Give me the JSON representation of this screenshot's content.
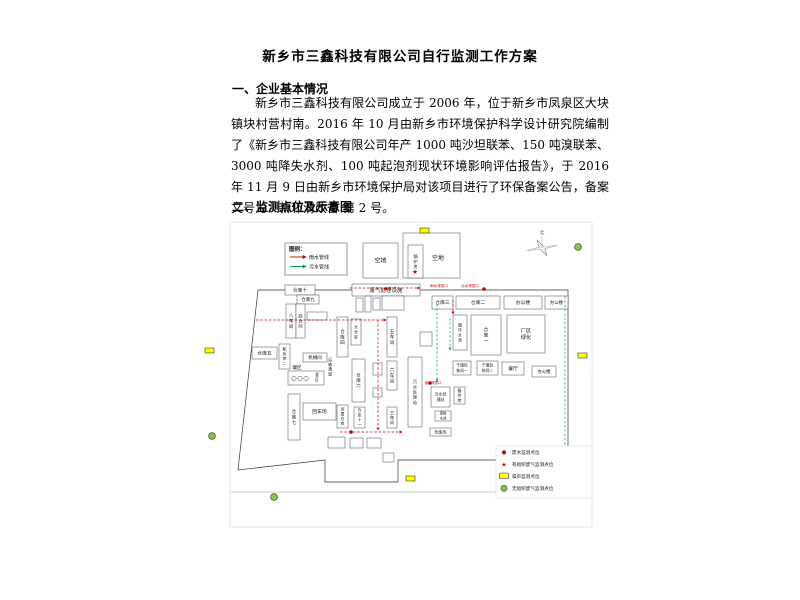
{
  "document": {
    "title": "新乡市三鑫科技有限公司自行监测工作方案",
    "section1_heading": "一、企业基本情况",
    "section1_paragraph": "新乡市三鑫科技有限公司成立于 2006 年，位于新乡市凤泉区大块镇块村营村南。2016 年 10 月由新乡市环境保护科学设计研究院编制了《新乡市三鑫科技有限公司年产 1000 吨沙坦联苯、150 吨溴联苯、3000 吨降失水剂、100 吨起泡剂现状环境影响评估报告》，于 2016 年 11 月 9 日由新乡市环境保护局对该项目进行了环保备案公告，备案文号为：新环清改备 第 2 号。",
    "section2_heading": "二、监测点位及示意图"
  },
  "diagram": {
    "compass_label": "北",
    "colors": {
      "rain": "#c00000",
      "sewage": "#00994d",
      "noise_fill": "#ffff00",
      "fugitive_fill": "#8bc34a",
      "fugitive_stroke": "#33691e",
      "marker_red": "#c00000"
    },
    "pipe_legend": {
      "title": "图例：",
      "items": [
        {
          "label": "雨水管线",
          "color": "#c00000"
        },
        {
          "label": "污水管线",
          "color": "#00994d"
        }
      ]
    },
    "point_legend": [
      {
        "icon": "wastewater-dot",
        "label": "废水监测点位"
      },
      {
        "icon": "stack-gas-star",
        "label": "有组织废气监测点位"
      },
      {
        "icon": "noise-rect",
        "label": "噪声监测点位"
      },
      {
        "icon": "fugitive-gas-circle",
        "label": "无组织废气监测点位"
      }
    ],
    "frame": {
      "x": 30,
      "y": 2,
      "w": 362,
      "h": 305
    },
    "road": {
      "x1": 31,
      "y1": 272,
      "x2": 390,
      "y2": 272
    },
    "fence_path": "M58,70 L368,70 L368,240 L198,240 L198,262 L125,262 L125,240 L38,250 Z",
    "boxes": [
      {
        "x": 85,
        "y": 65,
        "w": 30,
        "h": 10,
        "label": "仓库十",
        "m": "h",
        "fs": 4.8
      },
      {
        "x": 97,
        "y": 75,
        "w": 22,
        "h": 9,
        "label": "仓库九",
        "m": "h",
        "fs": 4.5
      },
      {
        "x": 86,
        "y": 84,
        "w": 10,
        "h": 34,
        "label": "八车间",
        "m": "v",
        "fs": 4.5
      },
      {
        "x": 96,
        "y": 84,
        "w": 9,
        "h": 34,
        "label": "综合间",
        "m": "v",
        "fs": 4.2
      },
      {
        "x": 107,
        "y": 92,
        "w": 20,
        "h": 8,
        "label": "",
        "m": "h"
      },
      {
        "x": 152,
        "y": 64,
        "w": 68,
        "h": 12,
        "label": "废气处理设施",
        "m": "h",
        "fs": 5.5
      },
      {
        "x": 156,
        "y": 78,
        "w": 7,
        "h": 14,
        "label": "",
        "m": "h"
      },
      {
        "x": 165,
        "y": 76,
        "w": 6,
        "h": 16,
        "label": "",
        "m": "h"
      },
      {
        "x": 173,
        "y": 78,
        "w": 7,
        "h": 12,
        "label": "",
        "m": "h"
      },
      {
        "x": 182,
        "y": 76,
        "w": 22,
        "h": 14,
        "label": "",
        "m": "h"
      },
      {
        "x": 220,
        "y": 112,
        "w": 12,
        "h": 14,
        "label": "",
        "m": "h"
      },
      {
        "x": 232,
        "y": 76,
        "w": 21,
        "h": 13,
        "label": "仓库三",
        "m": "h",
        "fs": 4.8
      },
      {
        "x": 256,
        "y": 76,
        "w": 44,
        "h": 13,
        "label": "仓库二",
        "m": "h",
        "fs": 4.8
      },
      {
        "x": 304,
        "y": 76,
        "w": 38,
        "h": 13,
        "label": "办公楼",
        "m": "h",
        "fs": 4.8
      },
      {
        "x": 345,
        "y": 76,
        "w": 23,
        "h": 13,
        "label": "办公楼",
        "m": "h",
        "fs": 4.3
      },
      {
        "x": 253,
        "y": 95,
        "w": 14,
        "h": 35,
        "label": "循环水池",
        "m": "v",
        "fs": 4
      },
      {
        "x": 271,
        "y": 95,
        "w": 30,
        "h": 40,
        "label": "仓库一",
        "m": "v",
        "fs": 4.8
      },
      {
        "x": 307,
        "y": 95,
        "w": 38,
        "h": 38,
        "label": "厂区绿化",
        "m": "2l",
        "lines": [
          "厂区",
          "绿化"
        ],
        "fs": 5.2
      },
      {
        "x": 137,
        "y": 97,
        "w": 11,
        "h": 40,
        "label": "仓库四",
        "m": "v",
        "fs": 4.5
      },
      {
        "x": 151,
        "y": 99,
        "w": 10,
        "h": 26,
        "label": "大仓库",
        "m": "v",
        "fs": 4
      },
      {
        "x": 187,
        "y": 97,
        "w": 10,
        "h": 40,
        "label": "五车间",
        "m": "v",
        "fs": 4.5
      },
      {
        "x": 52,
        "y": 127,
        "w": 25,
        "h": 12,
        "label": "仓库五",
        "m": "h",
        "fs": 4.8
      },
      {
        "x": 79,
        "y": 124,
        "w": 11,
        "h": 25,
        "label": "配件库二",
        "m": "v",
        "fs": 3.8
      },
      {
        "x": 103,
        "y": 133,
        "w": 24,
        "h": 9,
        "label": "机械间",
        "m": "h",
        "fs": 4.5
      },
      {
        "x": 88,
        "y": 151,
        "w": 36,
        "h": 14,
        "label": "",
        "m": "h"
      },
      {
        "x": 88,
        "y": 174,
        "w": 12,
        "h": 46,
        "label": "仓库七",
        "m": "v",
        "fs": 4.5
      },
      {
        "x": 103,
        "y": 183,
        "w": 33,
        "h": 17,
        "label": "回车场",
        "m": "h",
        "fs": 4.8
      },
      {
        "x": 137,
        "y": 185,
        "w": 11,
        "h": 23,
        "label": "闲置仓库",
        "m": "v",
        "fs": 3.8
      },
      {
        "x": 154,
        "y": 187,
        "w": 11,
        "h": 21,
        "label": "仓库十一",
        "m": "v",
        "fs": 3.8
      },
      {
        "x": 152,
        "y": 139,
        "w": 13,
        "h": 43,
        "label": "仓库六",
        "m": "v",
        "fs": 4.5
      },
      {
        "x": 173,
        "y": 143,
        "w": 9,
        "h": 12,
        "label": "",
        "m": "h"
      },
      {
        "x": 173,
        "y": 168,
        "w": 9,
        "h": 9,
        "label": "",
        "m": "h"
      },
      {
        "x": 187,
        "y": 141,
        "w": 10,
        "h": 29,
        "label": "六车间",
        "m": "v",
        "fs": 4.5
      },
      {
        "x": 187,
        "y": 187,
        "w": 10,
        "h": 21,
        "label": "三车间",
        "m": "v",
        "fs": 4.2
      },
      {
        "x": 208,
        "y": 137,
        "w": 14,
        "h": 70,
        "label": "污水处理站",
        "m": "v",
        "fs": 4.2
      },
      {
        "x": 231,
        "y": 167,
        "w": 19,
        "h": 20,
        "label": "污水处理站",
        "m": "2l",
        "lines": [
          "污水处",
          "理站"
        ],
        "fs": 4
      },
      {
        "x": 254,
        "y": 167,
        "w": 11,
        "h": 17,
        "label": "备件库",
        "m": "v",
        "fs": 4
      },
      {
        "x": 253,
        "y": 141,
        "w": 18,
        "h": 14,
        "label": "干燥包装间一",
        "m": "2l",
        "lines": [
          "干燥包",
          "装间一"
        ],
        "fs": 3.8
      },
      {
        "x": 277,
        "y": 141,
        "w": 21,
        "h": 14,
        "label": "干燥包装间二",
        "m": "2l",
        "lines": [
          "干燥包",
          "装间二"
        ],
        "fs": 3.8
      },
      {
        "x": 302,
        "y": 142,
        "w": 22,
        "h": 13,
        "label": "餐厅",
        "m": "h",
        "fs": 4.8
      },
      {
        "x": 332,
        "y": 146,
        "w": 24,
        "h": 11,
        "label": "办公楼",
        "m": "h",
        "fs": 4.3
      },
      {
        "x": 235,
        "y": 191,
        "w": 16,
        "h": 10,
        "label": "事故水池",
        "m": "2l",
        "lines": [
          "事故",
          "水池"
        ],
        "fs": 3.4
      },
      {
        "x": 230,
        "y": 208,
        "w": 21,
        "h": 8,
        "label": "危废库",
        "m": "h",
        "fs": 4
      },
      {
        "x": 128,
        "y": 217,
        "w": 17,
        "h": 11,
        "label": "",
        "m": "h"
      },
      {
        "x": 150,
        "y": 218,
        "w": 13,
        "h": 10,
        "label": "",
        "m": "h"
      },
      {
        "x": 167,
        "y": 218,
        "w": 14,
        "h": 10,
        "label": "",
        "m": "h"
      },
      {
        "x": 183,
        "y": 233,
        "w": 11,
        "h": 9,
        "label": "",
        "m": "h"
      },
      {
        "x": 163,
        "y": 23,
        "w": 35,
        "h": 35,
        "label": "空地",
        "m": "h",
        "fs": 6
      },
      {
        "x": 203,
        "y": 13,
        "w": 57,
        "h": 45,
        "label": "",
        "m": "h"
      },
      {
        "x": 208,
        "y": 25,
        "w": 15,
        "h": 33,
        "label": "锅炉房",
        "m": "v",
        "fs": 4.2
      }
    ],
    "labels": [
      {
        "x": 97,
        "y": 149,
        "text": "罐区",
        "fs": 4.5
      },
      {
        "x": 117,
        "y": 156,
        "text": "釜区",
        "fs": 3.8,
        "vertical": true
      },
      {
        "x": 238,
        "y": 40,
        "text": "空地",
        "fs": 6
      },
      {
        "x": 130,
        "y": 141,
        "text": "运输通道",
        "fs": 3.8,
        "vertical": true
      },
      {
        "x": 239,
        "y": 67,
        "text": "雨水排放口",
        "fs": 3.6,
        "color": "#c00000"
      },
      {
        "x": 270,
        "y": 67,
        "text": "污水排放口",
        "fs": 3.6,
        "color": "#c00000"
      },
      {
        "x": 233,
        "y": 164,
        "text": "废水排放口",
        "fs": 3.3,
        "color": "#c00000"
      }
    ],
    "tanks": [
      [
        94,
        158.5
      ],
      [
        100,
        158.5
      ],
      [
        106,
        158.5
      ]
    ],
    "pipes": {
      "rain": [
        [
          [
            56,
            100
          ],
          [
            186,
            100
          ]
        ],
        [
          [
            178,
            100
          ],
          [
            178,
            210
          ]
        ],
        [
          [
            140,
            212
          ],
          [
            202,
            212
          ]
        ],
        [
          [
            150,
            68
          ],
          [
            220,
            68
          ]
        ],
        [
          [
            253,
            80
          ],
          [
            253,
            94
          ]
        ]
      ],
      "sewage": [
        [
          [
            237,
            84
          ],
          [
            237,
            162
          ]
        ],
        [
          [
            365,
            76
          ],
          [
            365,
            236
          ]
        ],
        [
          [
            250,
            98
          ],
          [
            250,
            130
          ]
        ]
      ]
    },
    "markers": {
      "noise": [
        [
          220,
          8
        ],
        [
          5,
          128
        ],
        [
          378,
          133
        ],
        [
          206,
          256
        ]
      ],
      "fugitive": [
        [
          378,
          27
        ],
        [
          12,
          216
        ],
        [
          74,
          277
        ]
      ],
      "wastewater": [
        [
          284,
          69
        ],
        [
          230,
          163
        ],
        [
          151,
          212
        ]
      ],
      "stack": [
        [
          215,
          54
        ],
        [
          186,
          71
        ]
      ]
    }
  }
}
